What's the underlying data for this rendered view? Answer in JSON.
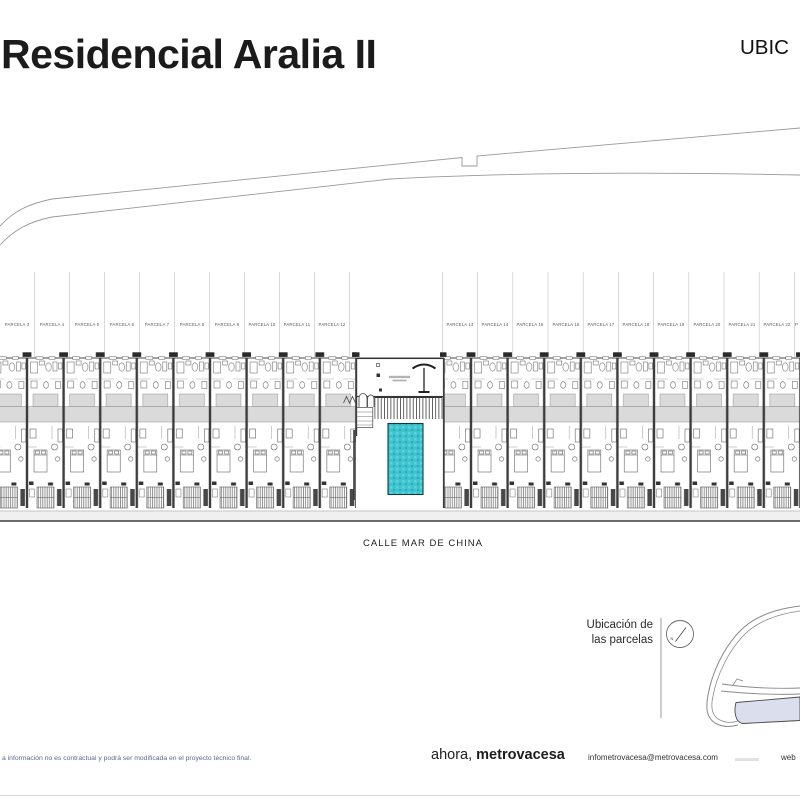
{
  "header": {
    "title": "Residencial Aralia II",
    "corner_label": "UBIC"
  },
  "plan": {
    "street_label": "CALLE MAR DE CHINA",
    "parcel_labels": [
      "PARCELA 3",
      "PARCELA 4",
      "PARCELA 5",
      "PARCELA 6",
      "PARCELA 7",
      "PARCELA 8",
      "PARCELA 9",
      "PARCELA 10",
      "PARCELA 11",
      "PARCELA 12",
      "PARCELA 13",
      "PARCELA 14",
      "PARCELA 15",
      "PARCELA 16",
      "PARCELA 17",
      "PARCELA 18",
      "PARCELA 19",
      "PARCELA 20",
      "PARCELA 21",
      "PARCELA 22",
      "P"
    ]
  },
  "map": {
    "caption_line1": "Ubicación de",
    "caption_line2": "las parcelas",
    "north_label": "N"
  },
  "footer": {
    "disclaimer": "a información no es contractual y podrá ser modificada en el proyecto técnico final.",
    "brand_regular": "ahora,",
    "brand_bold": "metrovacesa",
    "email": "infometrovacesa@metrovacesa.com",
    "web_label": "web"
  },
  "colors": {
    "pool": "#3fc3cf",
    "roof_band": "#dadada",
    "map_parcel_band": "#dbdeed",
    "disclaimer_text": "#5b6890"
  }
}
